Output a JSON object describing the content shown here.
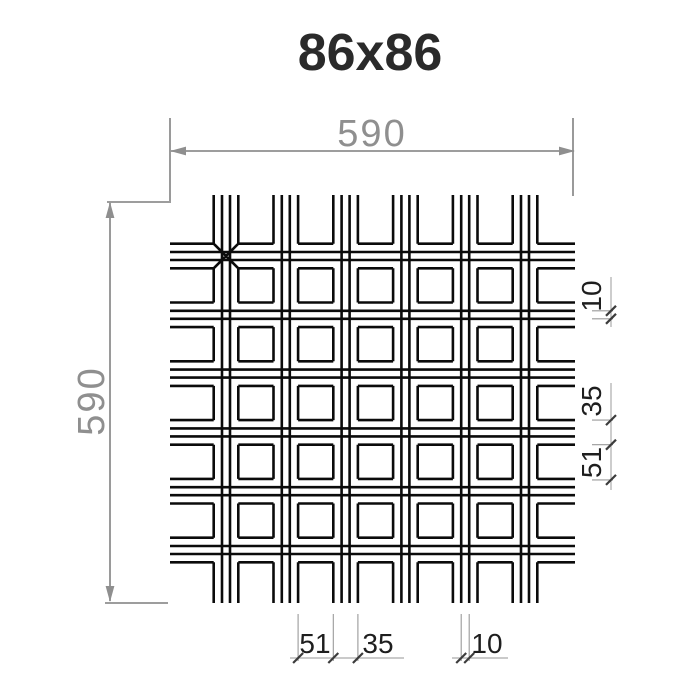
{
  "title": "86x86",
  "dims": {
    "top": {
      "label": "590"
    },
    "left": {
      "label": "590"
    },
    "right": [
      {
        "label": "10"
      },
      {
        "label": "35"
      },
      {
        "label": "51"
      }
    ],
    "bottom": [
      {
        "label": "51"
      },
      {
        "label": "35"
      },
      {
        "label": "10"
      }
    ]
  },
  "pattern": {
    "panel_size_mm": 590,
    "cell_pitch_mm": 86,
    "cell_opening_mm": 51,
    "web_between_openings_mm": 35,
    "blade_top_width_mm": 10,
    "blade_rows": 6,
    "blade_cols": 6
  },
  "colors": {
    "line_black": "#0b0b0b",
    "dim_gray": "#8f8f8f",
    "detail_line_gray": "#ababab",
    "tick_dark": "#3c3c3c",
    "text_dark": "#1e1e1e",
    "title_color": "#2a2a2a"
  }
}
